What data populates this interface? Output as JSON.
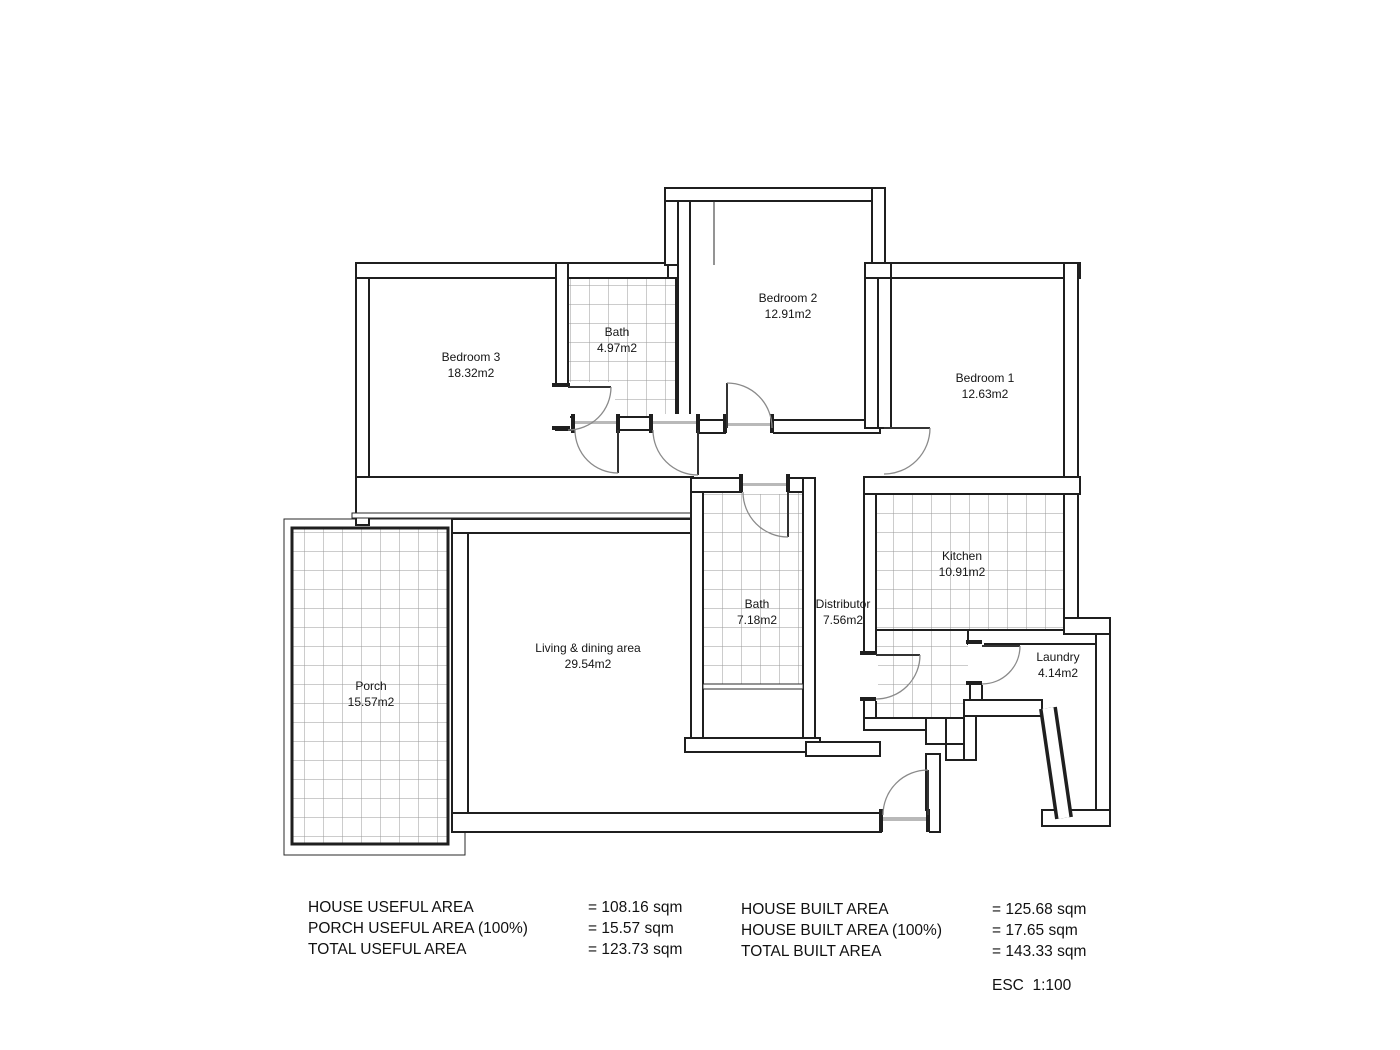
{
  "plan": {
    "rooms": [
      {
        "name": "Bedroom 3",
        "area": "18.32m2"
      },
      {
        "name": "Bath",
        "area": "4.97m2"
      },
      {
        "name": "Bedroom 2",
        "area": "12.91m2"
      },
      {
        "name": "Bedroom 1",
        "area": "12.63m2"
      },
      {
        "name": "Bath",
        "area": "7.18m2"
      },
      {
        "name": "Distributor",
        "area": "7.56m2"
      },
      {
        "name": "Kitchen",
        "area": "10.91m2"
      },
      {
        "name": "Laundry",
        "area": "4.14m2"
      },
      {
        "name": "Living & dining area",
        "area": "29.54m2"
      },
      {
        "name": "Porch",
        "area": "15.57m2"
      }
    ]
  },
  "summary": {
    "useful": [
      {
        "label": "HOUSE USEFUL AREA",
        "value": "= 108.16 sqm"
      },
      {
        "label": "PORCH USEFUL AREA (100%)",
        "value": "= 15.57 sqm"
      },
      {
        "label": "TOTAL USEFUL AREA",
        "value": "= 123.73 sqm"
      }
    ],
    "built": [
      {
        "label": "HOUSE BUILT AREA",
        "value": "= 125.68 sqm"
      },
      {
        "label": "HOUSE BUILT AREA (100%)",
        "value": "= 17.65 sqm"
      },
      {
        "label": "TOTAL BUILT AREA",
        "value": "= 143.33 sqm"
      }
    ],
    "scale": "ESC  1:100"
  },
  "colors": {
    "wall": "#1f1f1f",
    "tile_grid": "#9a9a9a",
    "door_arc": "#8a8a8a",
    "background": "#ffffff"
  }
}
